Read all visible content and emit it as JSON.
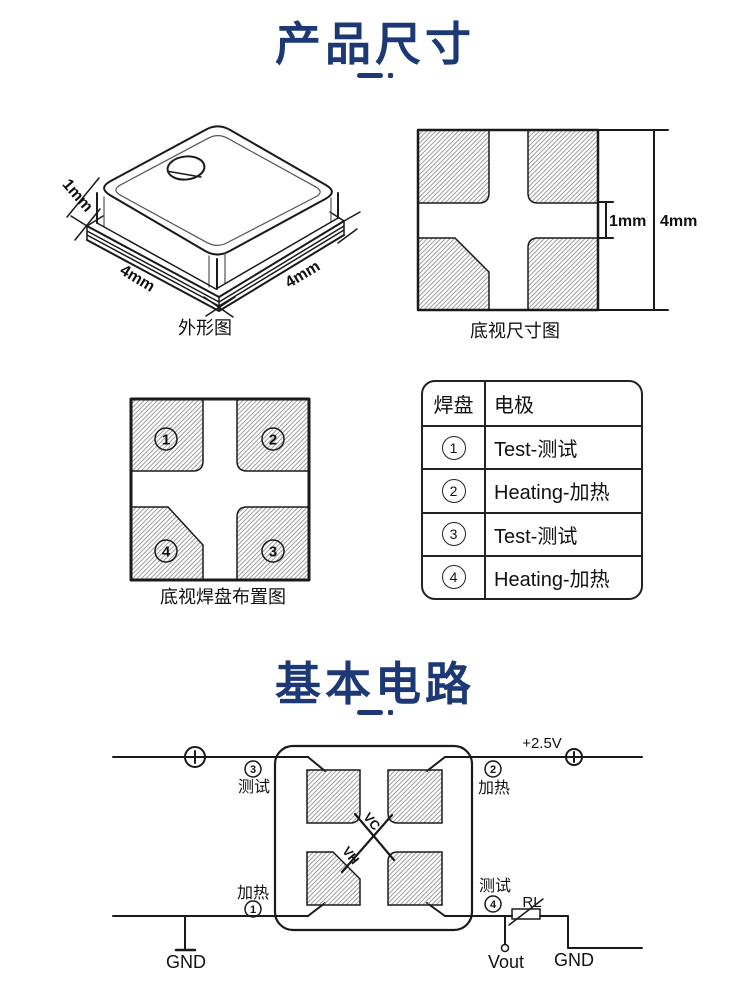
{
  "colors": {
    "accent": "#1c3875",
    "ink": "#1a1a1a",
    "hatch": "#a0a0a0"
  },
  "dimensions_section": {
    "title": "产品尺寸",
    "outline_drawing": {
      "caption": "外形图",
      "dim_height": "1mm",
      "dim_width_left": "4mm",
      "dim_width_right": "4mm"
    },
    "bottom_view_drawing": {
      "caption": "底视尺寸图",
      "dim_gap": "1mm",
      "dim_side": "4mm"
    },
    "pad_layout_drawing": {
      "caption": "底视焊盘布置图",
      "pad_numbers": [
        "1",
        "2",
        "3",
        "4"
      ]
    },
    "pad_table": {
      "headers": [
        "焊盘",
        "电极"
      ],
      "rows": [
        {
          "pad": "1",
          "electrode": "Test-测试"
        },
        {
          "pad": "2",
          "electrode": "Heating-加热"
        },
        {
          "pad": "3",
          "electrode": "Test-测试"
        },
        {
          "pad": "4",
          "electrode": "Heating-加热"
        }
      ]
    }
  },
  "circuit_section": {
    "title": "基本电路",
    "labels": {
      "supply": "+2.5V",
      "pin3_num": "3",
      "pin3_name": "测试",
      "pin2_num": "2",
      "pin2_name": "加热",
      "pin1_num": "1",
      "pin1_name": "加热",
      "pin4_num": "4",
      "pin4_name": "测试",
      "gnd_left": "GND",
      "gnd_right": "GND",
      "vout": "Vout",
      "load_resistor": "RL",
      "vc": "VC",
      "vh": "VH"
    }
  }
}
